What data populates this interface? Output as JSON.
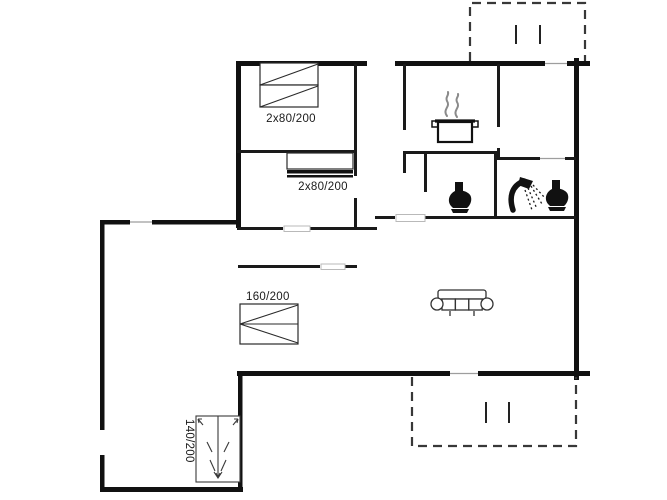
{
  "page": {
    "background": "#ffffff",
    "type": "holiday-house-floor-plan"
  },
  "colors": {
    "wall": "#111111",
    "interior_wall": "#1a1a1a",
    "terrace_dash": "#383838",
    "furniture_stroke": "#2a2a2a",
    "label_text": "#1a1a1a"
  },
  "beds": {
    "bunk_top_left": {
      "label": "2x80/200"
    },
    "bunk_mid_left": {
      "label": "2x80/200"
    },
    "double_mid_left": {
      "label": "160/200"
    },
    "double_bottom_left": {
      "label": "140/200"
    }
  },
  "icons": {
    "kitchen": "cooking-pot-steam-icon",
    "wc": "toilet-icon",
    "bathroom_shower": "shower-icon",
    "bathroom_toilet": "toilet-icon",
    "living_room": "sofa-icon",
    "terrace_top": "terrace-dashed-outline",
    "terrace_bottom": "terrace-dashed-outline"
  }
}
